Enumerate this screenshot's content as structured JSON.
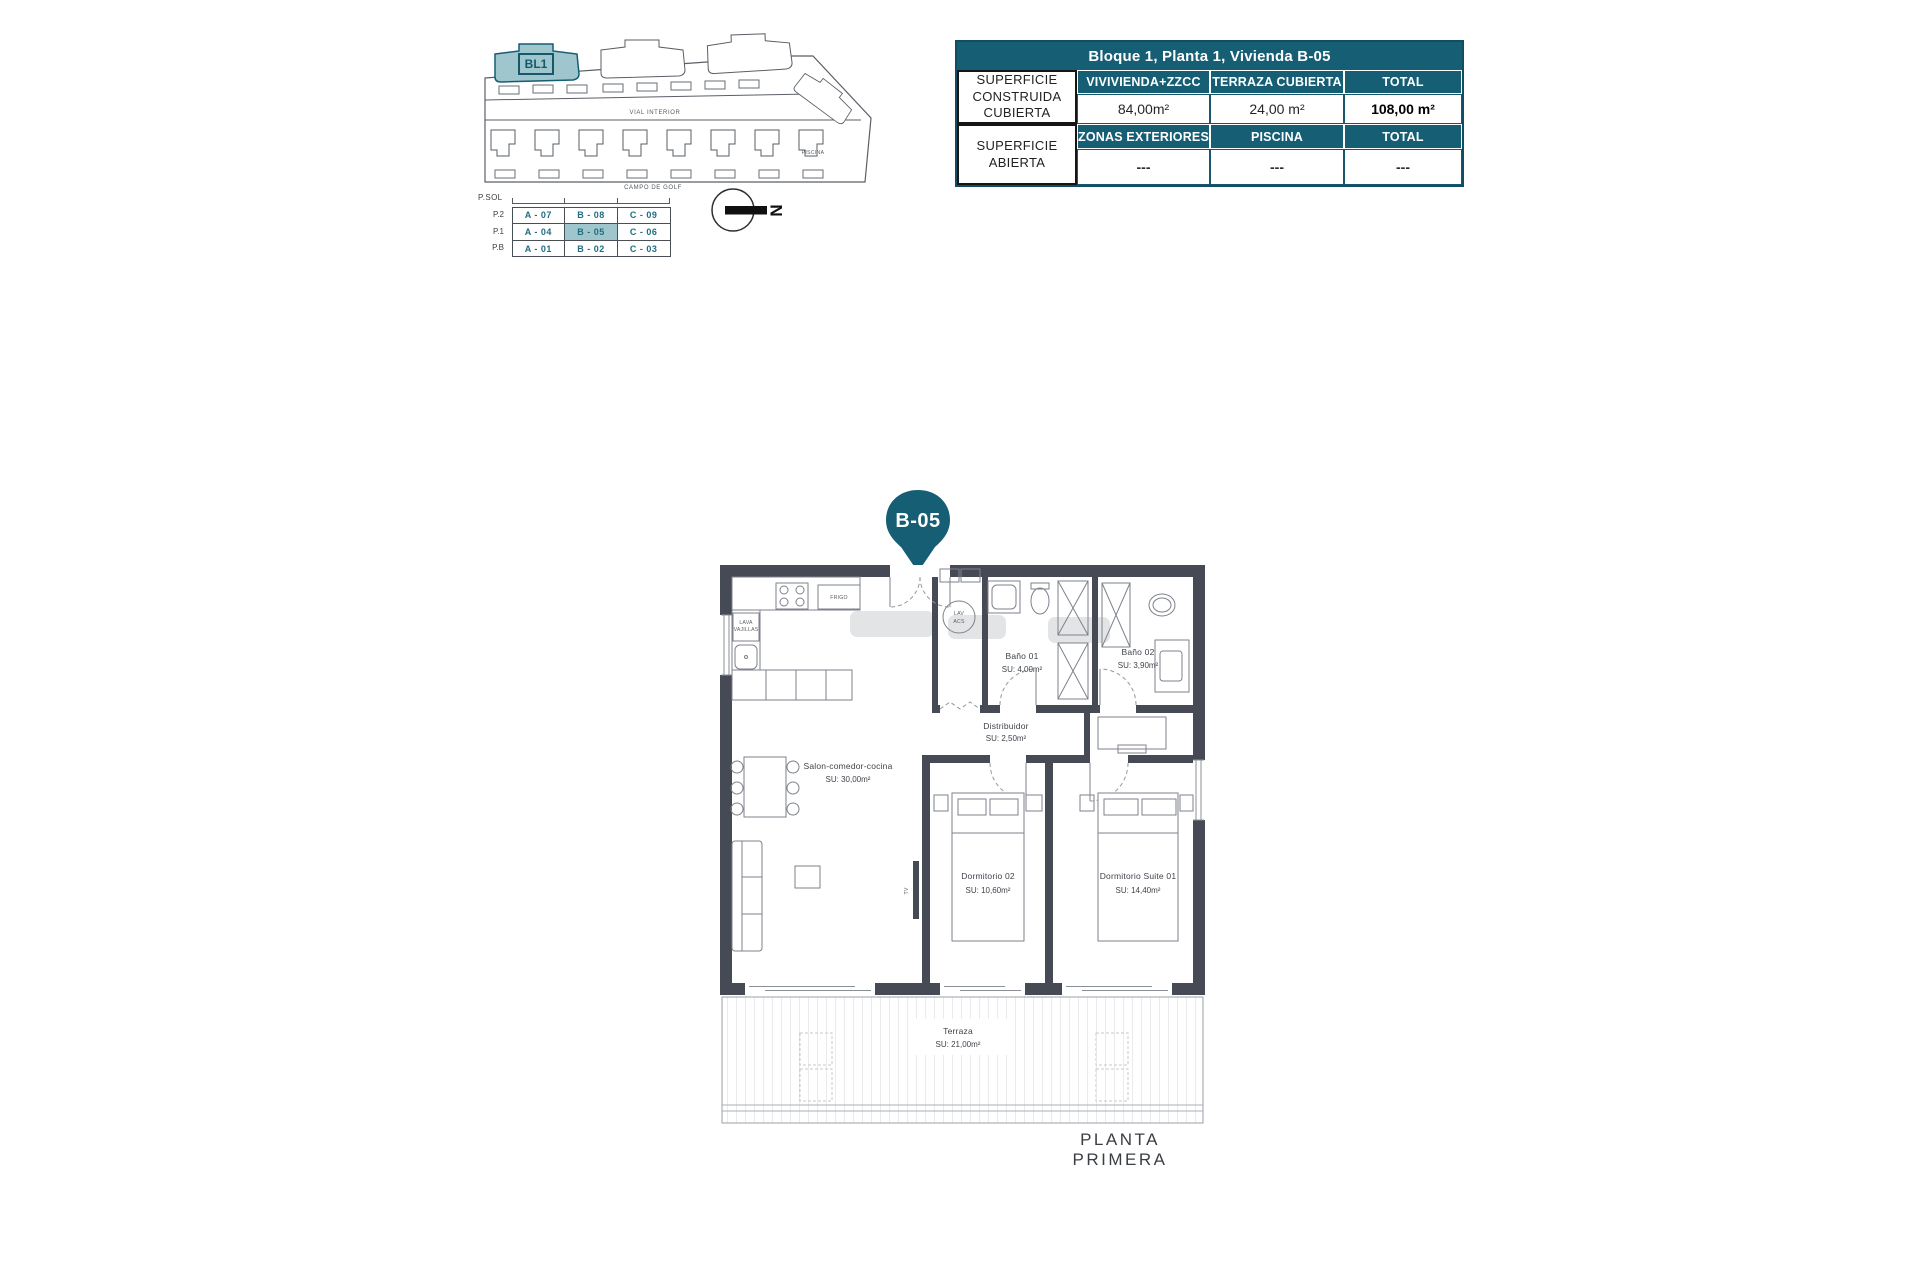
{
  "colors": {
    "teal": "#155e74",
    "teal_light": "#9fc5cd",
    "wall": "#454a54"
  },
  "site_plan": {
    "block_label": "BL1",
    "road_label": "VIAL INTERIOR",
    "golf_label": "CAMPO DE GOLF",
    "pool_label": "PISCINA",
    "north_label": "N"
  },
  "unit_grid": {
    "header": "P.SOL",
    "levels": [
      "P.2",
      "P.1",
      "P.B"
    ],
    "rows": [
      [
        "A - 07",
        "B - 08",
        "C - 09"
      ],
      [
        "A - 04",
        "B - 05",
        "C - 06"
      ],
      [
        "A - 01",
        "B - 02",
        "C - 03"
      ]
    ],
    "highlighted_unit": "B - 05"
  },
  "info_table": {
    "title": "Bloque 1, Planta 1, Vivienda B-05",
    "covered": {
      "label": "SUPERFICIE CONSTRUIDA CUBIERTA",
      "columns": [
        "VIVIVIENDA+ZZCC",
        "TERRAZA CUBIERTA",
        "TOTAL"
      ],
      "values": [
        "84,00m²",
        "24,00 m²",
        "108,00 m²"
      ]
    },
    "open": {
      "label": "SUPERFICIE ABIERTA",
      "columns": [
        "ZONAS EXTERIORES",
        "PISCINA",
        "TOTAL"
      ],
      "values": [
        "---",
        "---",
        "---"
      ]
    }
  },
  "pin": {
    "label": "B-05"
  },
  "floor_plan": {
    "caption": "PLANTA PRIMERA",
    "rooms": {
      "salon": {
        "name": "Salon-comedor-cocina",
        "area": "SU: 30,00m²"
      },
      "distribuidor": {
        "name": "Distribuidor",
        "area": "SU: 2,50m²"
      },
      "bano01": {
        "name": "Baño 01",
        "area": "SU: 4,00m²"
      },
      "bano02": {
        "name": "Baño 02",
        "area": "SU: 3,90m²"
      },
      "dormitorio02": {
        "name": "Dormitorio 02",
        "area": "SU: 10,60m²"
      },
      "suite": {
        "name": "Dormitorio Suite 01",
        "area": "SU: 14,40m²"
      },
      "terraza": {
        "name": "Terraza",
        "area": "SU: 21,00m²"
      }
    },
    "fixtures": {
      "frigo": "FRIGO",
      "lava": "LAVA",
      "vajillas": "VAJILLAS",
      "lav": "LAV",
      "acs": "ACS",
      "tv": "TV"
    }
  }
}
